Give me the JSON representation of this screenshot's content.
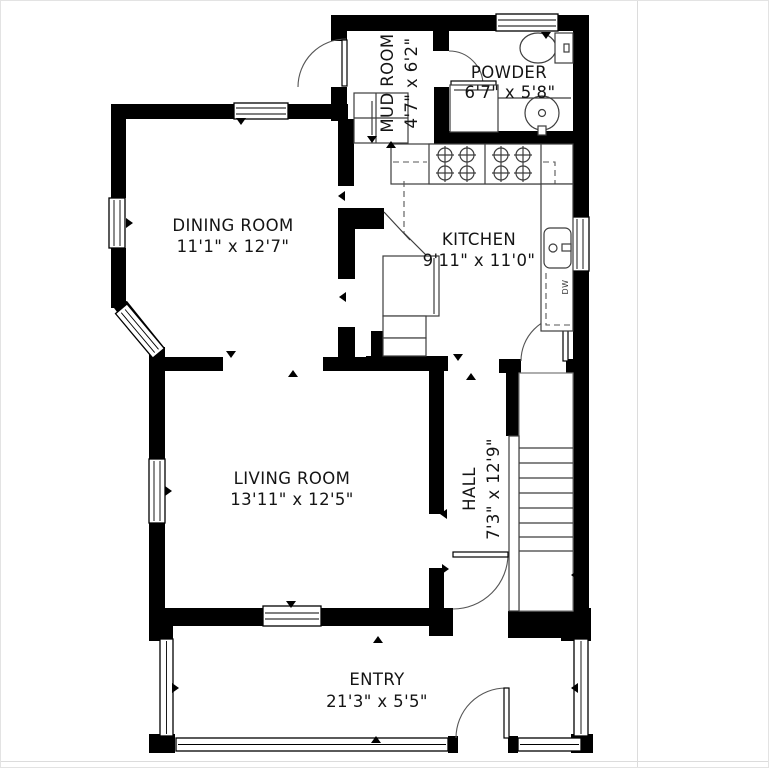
{
  "rooms": {
    "mud_room": {
      "name": "MUD ROOM",
      "dims": "4'7\" x 6'2\""
    },
    "powder": {
      "name": "POWDER",
      "dims": "6'7\" x 5'8\""
    },
    "dining": {
      "name": "DINING ROOM",
      "dims": "11'1\" x 12'7\""
    },
    "kitchen": {
      "name": "KITCHEN",
      "dims": "9'11\" x 11'0\""
    },
    "living": {
      "name": "LIVING ROOM",
      "dims": "13'11\" x 12'5\""
    },
    "hall": {
      "name": "HALL",
      "dims": "7'3\" x 12'9\""
    },
    "entry": {
      "name": "ENTRY",
      "dims": "21'3\" x 5'5\""
    }
  },
  "appliances": {
    "dishwasher": "DW"
  },
  "colors": {
    "wall": "#000000",
    "background": "#ffffff",
    "fixture_line": "#3d3d3d"
  }
}
